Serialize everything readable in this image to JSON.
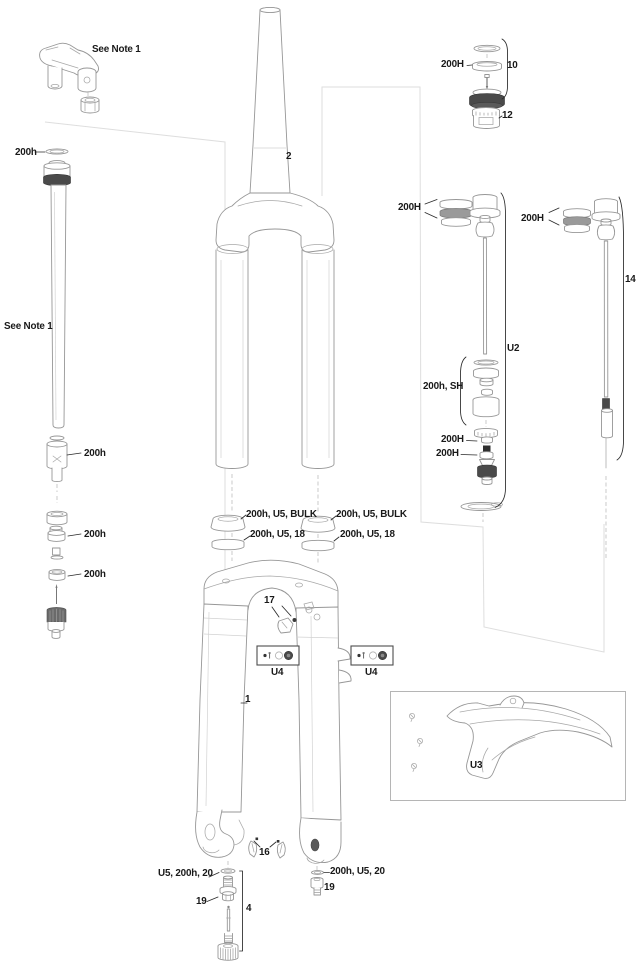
{
  "colors": {
    "ink": "#191919",
    "part_line": "#979797",
    "dark_fill": "#4a4a4a",
    "sheet_line": "#dedede",
    "box_border": "#4d4d4d"
  },
  "labels": {
    "note_top": "See Note 1",
    "note_left": "See Note 1",
    "seal_top": "200h",
    "piston_ring": "200h",
    "ring_low1": "200h",
    "ring_low2": "200h",
    "steerer_num": "2",
    "cap_ring": "200H",
    "cap_group_num": "10",
    "cap_part_num": "12",
    "mid_rings": "200H",
    "right_rings": "200H",
    "right_group_num": "14",
    "damper_group": "U2",
    "sealhead": "200h, SH",
    "shim_a": "200H",
    "shim_b": "200H",
    "dust_seal_left": "200h, U5, BULK",
    "foam_ring_left": "200h, U5, 18",
    "dust_seal_right": "200h, U5, BULK",
    "foam_ring_right": "200h, U5, 18",
    "guide_num": "17",
    "u4_left": "U4",
    "u4_right": "U4",
    "lowers_num": "1",
    "fender_group": "U3",
    "clip_num": "16",
    "washer_left": "U5, 200h, 20",
    "bolt_left_num": "19",
    "rebound_group_num": "4",
    "washer_right": "200h, U5, 20",
    "bolt_right_num": "19"
  }
}
